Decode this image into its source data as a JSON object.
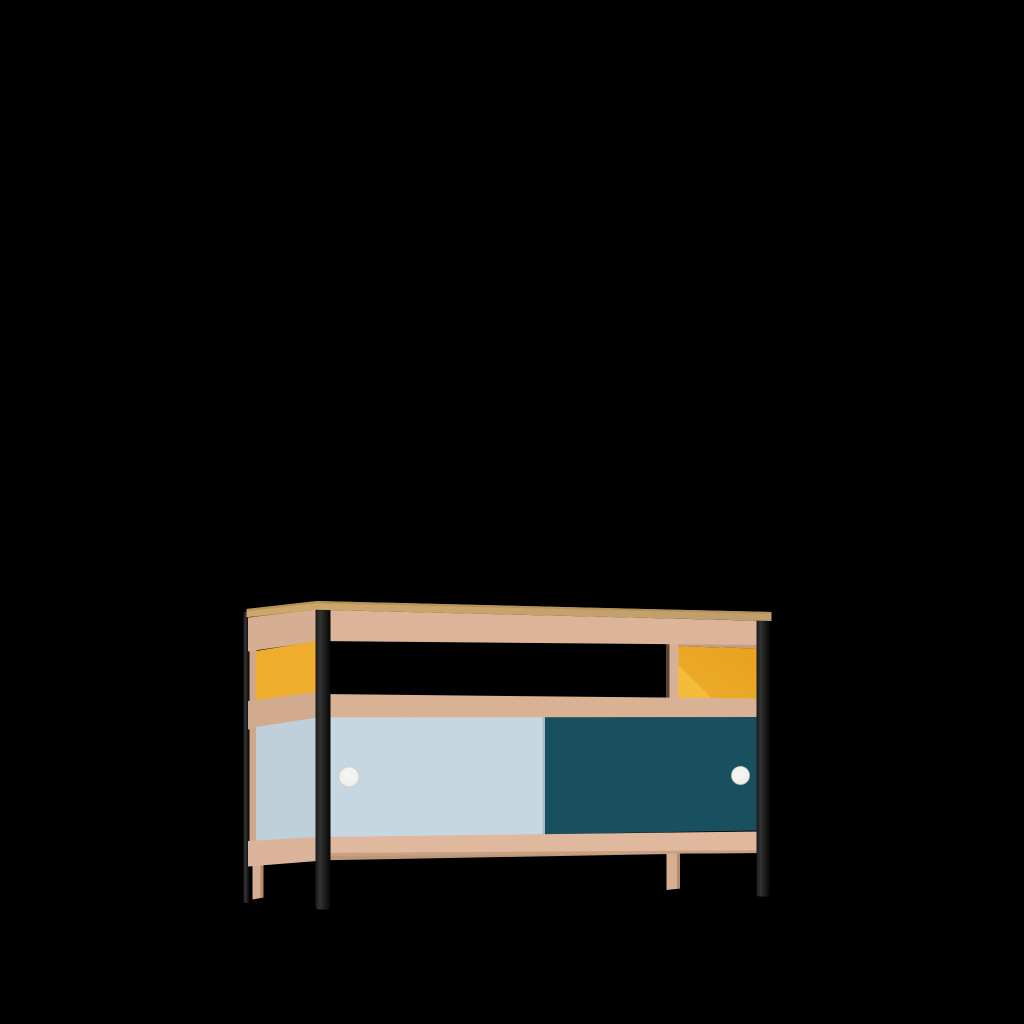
{
  "scene": {
    "type": "product-render",
    "object": "sideboard-tv-cabinet",
    "view": "front-left-three-quarter",
    "parts": {
      "top": "oak-tabletop",
      "frame": "beech-wood-rails",
      "left_side_upper_panel": "yellow",
      "left_side_lower_panel": "light-blue",
      "open_shelf": "middle-open-through",
      "right_compartment_back": "yellow",
      "sliding_door_left": "light-blue",
      "sliding_door_right": "dark-teal",
      "handles": "white-round",
      "metal_legs": "black",
      "rear_support_legs": "wood"
    }
  },
  "colors": {
    "background": "#000000",
    "oak_top_light": "#cfa76a",
    "oak_top_dark": "#bf9e6c",
    "oak_top_edge": "#b09055",
    "frame_wood": "#dbb499",
    "frame_wood_mid": "#d9b296",
    "frame_wood_bottom": "#dfb89d",
    "frame_wood_bottom_shade": "#c79f81",
    "frame_wood_side": "#d5ae93",
    "frame_wood_side_mid": "#d1aa8f",
    "frame_wood_side_bottom": "#dab39a",
    "corner_upright_wood": "#cfa88c",
    "rear_rail_wood": "#bd977b",
    "wood_leg": "#d6af93",
    "wood_leg_shade": "#b28b6e",
    "panel_yellow": "#eead2c",
    "panel_yellow_deep": "#e7a21e",
    "panel_yellow_light": "#f4ba39",
    "door_blue": "#c7d7e1",
    "door_blue_edge": "#a9bcc7",
    "side_blue": "#c0d0db",
    "door_teal": "#19505f",
    "leg_black_edge": "#1a1a1a",
    "leg_black_hi": "#333333",
    "leg_black_dark": "#050505",
    "handle_white": "#f0efeb",
    "handle_white_hi": "#f7f6f3",
    "handle_white_shade": "#dddbd3",
    "handle_rim": "#cfcdc5",
    "divider_wood": "#d7b195",
    "divider_shadow": "#5c4633",
    "underboard_wood": "#c49d80"
  }
}
